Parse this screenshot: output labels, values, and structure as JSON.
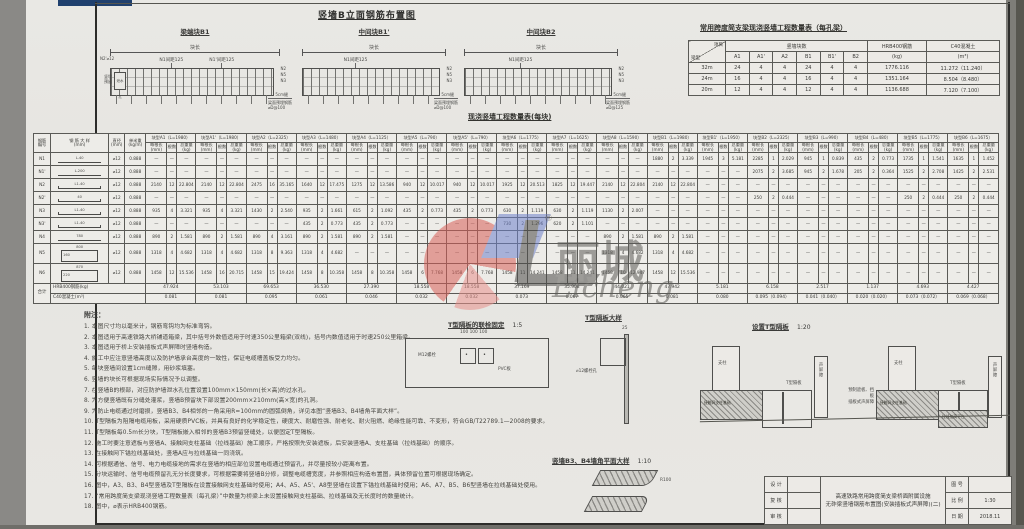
{
  "watermark": {
    "cn": "丽城",
    "en": "Licheng",
    "reg": "®"
  },
  "elevation_section": {
    "title": "竖墙B立面钢筋布置图",
    "panels": [
      {
        "title": "梁端块B1",
        "top_dim": "块长",
        "bar1": "N1间距125",
        "bar2": "N1'间距125",
        "left_top": "N2'⌀12",
        "left_side": "竖墙 预留",
        "hole": "泄水孔",
        "right1": "N2",
        "right2": "N5",
        "right3": "N3",
        "gap": "5cm缝",
        "bottom1": "梁面预埋钢筋",
        "bottom2": "⌀D@100",
        "has_hole": true
      },
      {
        "title": "中间块B1'",
        "top_dim": "块长",
        "bar1": "N1间距125",
        "bar2": "",
        "left_top": "",
        "left_side": "",
        "hole": "",
        "right1": "N2",
        "right2": "N5",
        "right3": "N3",
        "gap": "5cm缝",
        "bottom1": "梁面预埋钢筋",
        "bottom2": "⌀D@100",
        "has_hole": false
      },
      {
        "title": "中间块B2",
        "top_dim": "块长",
        "bar1": "N1间距125",
        "bar2": "",
        "left_top": "",
        "left_side": "",
        "hole": "",
        "right1": "N2",
        "right2": "N5",
        "right3": "N3",
        "gap": "5cm缝",
        "bottom1": "梁面预埋钢筋",
        "bottom2": "⌀D@125",
        "has_hole": false
      }
    ]
  },
  "qty_table": {
    "title": "常用跨度简支梁现浇竖墙工程数量表（每孔梁）",
    "corner_top": "项目",
    "corner_bottom": "梁型",
    "group_blocks": "竖墙块数",
    "block_cols": [
      "A1",
      "A1'",
      "A2",
      "B1",
      "B1'",
      "B2"
    ],
    "steel_head": "HRB400钢筋",
    "steel_unit": "(kg)",
    "conc_head": "C40混凝土",
    "conc_unit": "(m³)",
    "rows": [
      {
        "span": "32m",
        "blocks": [
          "24",
          "4",
          "4",
          "24",
          "4",
          "4"
        ],
        "steel": "1776.116",
        "conc": "11.272（11.240）"
      },
      {
        "span": "24m",
        "blocks": [
          "16",
          "4",
          "4",
          "16",
          "4",
          "4"
        ],
        "steel": "1351.164",
        "conc": "8.504（8.480）"
      },
      {
        "span": "20m",
        "blocks": [
          "12",
          "4",
          "4",
          "12",
          "4",
          "4"
        ],
        "steel": "1136.688",
        "conc": "7.120（7.100）"
      }
    ]
  },
  "main_table": {
    "title": "现浇竖墙工程数量表(每块)",
    "lead_headers": [
      [
        "钢筋",
        "编号"
      ],
      [
        "钢 筋 大 样",
        "(mm)"
      ],
      [
        "直径",
        "(mm)"
      ],
      [
        "单米重",
        "(kg/m)"
      ]
    ],
    "sub_headers": [
      "每根长(mm)",
      "根数",
      "总重量(kg)"
    ],
    "dash": "—",
    "groups": [
      {
        "name": "块型A1（L=1980）"
      },
      {
        "name": "块型A1'（L=1980）"
      },
      {
        "name": "块型A2（L=2325）"
      },
      {
        "name": "块型A3（L=1480）"
      },
      {
        "name": "块型A4（L=1125）"
      },
      {
        "name": "块型A5（L=790）"
      },
      {
        "name": "块型A5'（L=790）"
      },
      {
        "name": "块型A6（L=1775）"
      },
      {
        "name": "块型A7（L=1625）"
      },
      {
        "name": "块型A8（L=1590）"
      },
      {
        "name": "块型B1（L=1980）"
      },
      {
        "name": "块型B1'（L=1950）"
      },
      {
        "name": "块型B2（L=2325）"
      },
      {
        "name": "块型B3（L=990）"
      },
      {
        "name": "块型B4（L=480）"
      },
      {
        "name": "块型B5（L=1775）"
      },
      {
        "name": "块型B6（L=1675）"
      }
    ],
    "rows": [
      {
        "no": "N1",
        "shape": "line",
        "dim": "L-40",
        "dia": "⌀12",
        "unit_w": "0.888",
        "cells": [
          null,
          null,
          null,
          null,
          null,
          null,
          null,
          null,
          null,
          null,
          [
            "1880",
            "2",
            "3.339"
          ],
          [
            "1945",
            "3",
            "5.181"
          ],
          [
            "2285",
            "1",
            "2.029"
          ],
          [
            "945",
            "1",
            "0.839"
          ],
          [
            "435",
            "2",
            "0.773"
          ],
          [
            "1735",
            "1",
            "1.541"
          ],
          [
            "1635",
            "1",
            "1.452"
          ]
        ]
      },
      {
        "no": "N1'",
        "shape": "line",
        "dim": "L-200",
        "dia": "⌀12",
        "unit_w": "0.888",
        "cells": [
          null,
          null,
          null,
          null,
          null,
          null,
          null,
          null,
          null,
          null,
          null,
          null,
          [
            "2075",
            "2",
            "3.685"
          ],
          [
            "945",
            "2",
            "1.678"
          ],
          [
            "205",
            "2",
            "0.364"
          ],
          [
            "1525",
            "2",
            "2.708"
          ],
          [
            "1425",
            "2",
            "2.531"
          ]
        ]
      },
      {
        "no": "N2",
        "shape": "hook",
        "dim": "L1-40",
        "dia": "⌀12",
        "unit_w": "0.888",
        "cells": [
          [
            "2140",
            "12",
            "22.804"
          ],
          [
            "2140",
            "12",
            "22.804"
          ],
          [
            "2475",
            "16",
            "35.165"
          ],
          [
            "1640",
            "12",
            "17.475"
          ],
          [
            "1275",
            "12",
            "13.586"
          ],
          [
            "940",
            "12",
            "10.017"
          ],
          [
            "940",
            "12",
            "10.017"
          ],
          [
            "1925",
            "12",
            "20.513"
          ],
          [
            "1825",
            "12",
            "19.447"
          ],
          [
            "2140",
            "12",
            "22.804"
          ],
          [
            "2140",
            "12",
            "22.804"
          ],
          null,
          null,
          null,
          null,
          null,
          null
        ]
      },
      {
        "no": "N2'",
        "shape": "hook",
        "dim": "40",
        "dia": "⌀12",
        "unit_w": "0.888",
        "cells": [
          null,
          null,
          null,
          null,
          null,
          null,
          null,
          null,
          null,
          null,
          null,
          null,
          [
            "250",
            "2",
            "0.444"
          ],
          null,
          null,
          [
            "250",
            "2",
            "0.444"
          ],
          [
            "250",
            "2",
            "0.444"
          ]
        ]
      },
      {
        "no": "N3",
        "shape": "hook",
        "dim": "L1-40",
        "dia": "⌀12",
        "unit_w": "0.888",
        "cells": [
          [
            "935",
            "4",
            "3.321"
          ],
          [
            "935",
            "4",
            "3.321"
          ],
          [
            "1430",
            "2",
            "2.540"
          ],
          [
            "935",
            "2",
            "1.661"
          ],
          [
            "615",
            "2",
            "1.092"
          ],
          [
            "435",
            "2",
            "0.773"
          ],
          [
            "435",
            "2",
            "0.773"
          ],
          [
            "630",
            "2",
            "1.119"
          ],
          [
            "630",
            "2",
            "1.119"
          ],
          [
            "1130",
            "2",
            "2.007"
          ],
          null,
          null,
          null,
          null,
          null,
          null,
          null
        ]
      },
      {
        "no": "N3'",
        "shape": "hook",
        "dim": "L1-40",
        "dia": "⌀12",
        "unit_w": "0.888",
        "cells": [
          null,
          null,
          null,
          [
            "435",
            "2",
            "0.773"
          ],
          [
            "435",
            "2",
            "0.773"
          ],
          null,
          null,
          [
            "730",
            "2",
            "1.296"
          ],
          [
            "620",
            "2",
            "1.101"
          ],
          null,
          null,
          null,
          null,
          null,
          null,
          null,
          null
        ]
      },
      {
        "no": "N4",
        "shape": "line",
        "dim": "780",
        "dia": "⌀12",
        "unit_w": "0.888",
        "cells": [
          [
            "890",
            "2",
            "1.581"
          ],
          [
            "890",
            "2",
            "1.581"
          ],
          [
            "890",
            "4",
            "3.161"
          ],
          [
            "890",
            "2",
            "1.581"
          ],
          [
            "890",
            "2",
            "1.581"
          ],
          null,
          null,
          null,
          null,
          [
            "890",
            "2",
            "1.581"
          ],
          [
            "890",
            "2",
            "1.581"
          ],
          null,
          null,
          null,
          null,
          null,
          null
        ]
      },
      {
        "no": "N5",
        "shape": "rect",
        "dim": "800",
        "dim2": "160",
        "dia": "⌀12",
        "unit_w": "0.888",
        "cells": [
          [
            "1318",
            "4",
            "4.682"
          ],
          [
            "1318",
            "4",
            "4.682"
          ],
          [
            "1318",
            "8",
            "9.363"
          ],
          [
            "1318",
            "4",
            "4.682"
          ],
          null,
          null,
          null,
          null,
          null,
          [
            "1318",
            "4",
            "4.682"
          ],
          [
            "1318",
            "4",
            "4.682"
          ],
          null,
          null,
          null,
          null,
          null,
          null
        ]
      },
      {
        "no": "N6",
        "shape": "rect",
        "dim": "870",
        "dim2": "220",
        "dia": "⌀12",
        "unit_w": "0.888",
        "cells": [
          [
            "1458",
            "12",
            "15.536"
          ],
          [
            "1458",
            "16",
            "20.715"
          ],
          [
            "1458",
            "15",
            "19.424"
          ],
          [
            "1458",
            "8",
            "10.358"
          ],
          [
            "1458",
            "8",
            "10.358"
          ],
          [
            "1458",
            "6",
            "7.768"
          ],
          [
            "1458",
            "6",
            "7.768"
          ],
          [
            "1458",
            "11",
            "14.241"
          ],
          [
            "1458",
            "11",
            "14.241"
          ],
          [
            "1458",
            "10",
            "12.947"
          ],
          [
            "1458",
            "12",
            "15.536"
          ],
          null,
          null,
          null,
          null,
          null,
          null
        ]
      }
    ],
    "totals_label": "合计",
    "steel_label": "HRB400钢筋(kg)",
    "conc_label": "C40混凝土(m³)",
    "steel_totals": [
      "47.924",
      "53.103",
      "69.653",
      "36.530",
      "27.390",
      "18.558",
      "18.558",
      "37.169",
      "35.908",
      "44.021",
      "47.942",
      "5.181",
      "6.158",
      "2.517",
      "1.137",
      "4.693",
      "4.427"
    ],
    "conc_totals": [
      "0.081",
      "0.081",
      "0.095",
      "0.061",
      "0.046",
      "0.032",
      "0.032",
      "0.073",
      "0.067",
      "0.065",
      "0.081",
      "0.080",
      "0.095（0.094）",
      "0.041（0.040）",
      "0.020（0.020）",
      "0.073（0.072）",
      "0.069（0.068）"
    ]
  },
  "notes": {
    "title": "附注：",
    "items": [
      "本图尺寸均以毫米计，钢筋弯钩均为标准弯钩。",
      "本图适用于高速铁路大桥铺道箱梁，其中括号外数值适用于时速350公里箱梁(双线)，括号内数值适用于时速250公里箱梁。",
      "本图适用于桥上安装插板式声屏障时竖墙构造。",
      "施工中应注意竖墙高度以及防护墙承台高度的一致性，保证电缆槽盖板受力均匀。",
      "每块竖墙间设置1cm缝隙，用砂浆填塞。",
      "竖墙的块长可根据现场实际情况予以调整。",
      "在竖墙B的根部，对应防护墙泄水孔位置设置100mm×150mm(长×高)的过水孔。",
      "为方便竖墙既有分缝处灌浆，竖墙B预留块下部设置200mm×210mm(高×宽)的孔洞。",
      "为防止电缆通过时磨损，竖墙B3、B4相邻的一角采用R=100mm的圆弧倒角，详见本图“竖墙B3、B4墙角平面大样”。",
      "T型隔板为阻隔电缆用板，采用硬质PVC板，并具有良好的化学稳定性，硬度大、耐磨性强、耐老化、耐火阻燃、绝缘性能可靠、不变形，符合GB/T22789.1—2008的要求。",
      "T型隔板每0.5m长分块，T型隔板嵌入相邻的竖墙B3预留竖缝处，以便固定T型隔板。",
      "施工时要注意遮板与竖墙A、接触网支柱基础（拉线基础）施工顺序，严格按照先安装遮板，后安装竖墙A、支柱基础（拉线基础）的顺序。",
      "在接触网下锚拉线基础处，竖墙A应与拉线基础一同浇筑。",
      "可根据通信、信号、电力电缆接地的需求在竖墙的相应部位设置电缆通过预留孔，并尽量按较小距离布置。",
      "分块运输时、信号电缆预留孔无分长度要求，可根据需要将竖墙B分修，调整电缆槽宽度，并参照相应构造布置图，具体预留位置可根据现场确定。",
      "图中，A3、B3、B4型竖墙及T型隔板在设置接触网支柱基础时使用；A4、A5、A5'、A8型竖墙在设置下锚拉线基础时使用；A6、A7、B5、B6型竖墙在拉线基础处使用。",
      "“常用跨度简支梁现浇竖墙工程数量表（每孔梁）”中数量为桥梁上未设置接触网支柱基础、拉线基础及无长度时的数量统计。",
      "图中，⌀表示HRB400钢筋。"
    ]
  },
  "details": {
    "t_fix": {
      "title": "T型隔板的联栓固定",
      "scale": "1:5",
      "bolt": "M12螺栓",
      "pvc": "PVC板",
      "dims": "100  100  100"
    },
    "t_sample": {
      "title": "T型隔板大样",
      "hole": "⌀12螺栓孔",
      "dim_top": "25"
    },
    "t_install": {
      "title": "设置T型隔板",
      "scale": "1:20",
      "col": "支柱",
      "board": "T型隔板",
      "found": "接触网支柱基础",
      "platform": "拉线加高平台",
      "barrier": "声屏障",
      "left_note1": "预制遮板、挡板",
      "left_note2": "插板式声屏障"
    },
    "corner": {
      "title": "竖墙B3、B4墙角平面大样",
      "scale": "1:10",
      "radius": "R100"
    }
  },
  "title_block": {
    "sign_rows": [
      "设 计",
      "复 核",
      "审 核"
    ],
    "project_line1": "高速铁路常用跨度简支梁桥面附属设施",
    "project_line2": "无砟梁竖墙钢筋布置图(安装插板式声屏障)(二)",
    "no_label": "图 号",
    "no_value": "",
    "scale_label": "比 例",
    "scale_value": "1:30",
    "date_label": "日 期",
    "date_value": "2018.11"
  }
}
